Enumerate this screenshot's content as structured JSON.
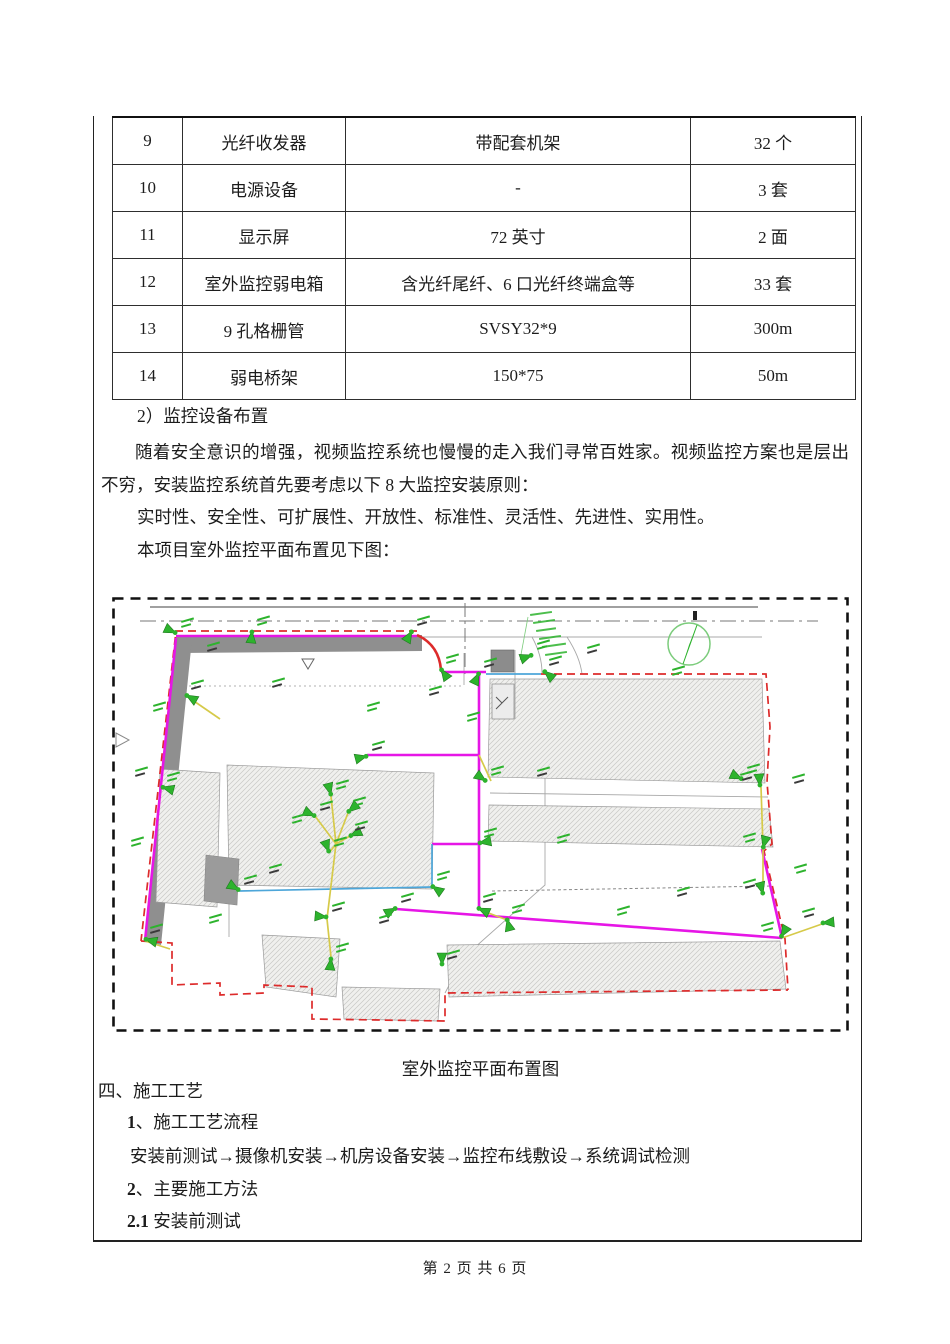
{
  "table": {
    "rows": [
      {
        "no": "9",
        "name": "光纤收发器",
        "spec": "带配套机架",
        "qty": "32 个"
      },
      {
        "no": "10",
        "name": "电源设备",
        "spec": "-",
        "qty": "3 套"
      },
      {
        "no": "11",
        "name": "显示屏",
        "spec": "72 英寸",
        "qty": "2 面"
      },
      {
        "no": "12",
        "name": "室外监控弱电箱",
        "spec": "含光纤尾纤、6 口光纤终端盒等",
        "qty": "33 套"
      },
      {
        "no": "13",
        "name": "9 孔格栅管",
        "spec": "SVSY32*9",
        "qty": "300m"
      },
      {
        "no": "14",
        "name": "弱电桥架",
        "spec": "150*75",
        "qty": "50m"
      }
    ]
  },
  "paragraphs": {
    "item2_heading": "2）监控设备布置",
    "p1": "随着安全意识的增强，视频监控系统也慢慢的走入我们寻常百姓家。视频监控方案也是层出不穷，安装监控系统首先要考虑以下 8 大监控安装原则：",
    "p2": "实时性、安全性、可扩展性、开放性、标准性、灵活性、先进性、实用性。",
    "p3": "本项目室外监控平面布置见下图："
  },
  "figure": {
    "caption": "室外监控平面布置图",
    "colors": {
      "magenta": "#e616e6",
      "red": "#dd2b2b",
      "green": "#2db32d",
      "yellow": "#d6ca49",
      "blue": "#4da6d9",
      "road": "#8f8f8f"
    },
    "cameras": [
      [
        64,
        36,
        205
      ],
      [
        74,
        98,
        30
      ],
      [
        50,
        190,
        15
      ],
      [
        33,
        342,
        15
      ],
      [
        140,
        34,
        95
      ],
      [
        300,
        34,
        120
      ],
      [
        329,
        72,
        55
      ],
      [
        367,
        76,
        115
      ],
      [
        420,
        58,
        160
      ],
      [
        432,
        74,
        40
      ],
      [
        374,
        184,
        215
      ],
      [
        255,
        159,
        165
      ],
      [
        219,
        198,
        255
      ],
      [
        203,
        219,
        205
      ],
      [
        236,
        215,
        320
      ],
      [
        238,
        239,
        335
      ],
      [
        217,
        255,
        250
      ],
      [
        215,
        320,
        185
      ],
      [
        219,
        361,
        95
      ],
      [
        284,
        311,
        150
      ],
      [
        320,
        289,
        35
      ],
      [
        127,
        293,
        210
      ],
      [
        367,
        246,
        350
      ],
      [
        366,
        311,
        25
      ],
      [
        395,
        322,
        75
      ],
      [
        648,
        189,
        265
      ],
      [
        651,
        251,
        285
      ],
      [
        651,
        297,
        255
      ],
      [
        669,
        340,
        300
      ],
      [
        710,
        326,
        355
      ],
      [
        630,
        182,
        205
      ],
      [
        330,
        368,
        270
      ]
    ],
    "extra_labels": [
      [
        90,
        60
      ],
      [
        36,
        120
      ],
      [
        18,
        185
      ],
      [
        14,
        255
      ],
      [
        155,
        96
      ],
      [
        250,
        120
      ],
      [
        312,
        104
      ],
      [
        350,
        130
      ],
      [
        420,
        185
      ],
      [
        175,
        232
      ],
      [
        152,
        282
      ],
      [
        92,
        332
      ],
      [
        262,
        332
      ],
      [
        440,
        252
      ],
      [
        470,
        62
      ],
      [
        555,
        84
      ],
      [
        700,
        192
      ],
      [
        702,
        282
      ],
      [
        560,
        305
      ],
      [
        500,
        324
      ]
    ]
  },
  "section4": {
    "heading": "四、施工工艺",
    "sub1_num": "1",
    "sub1_rest": "、施工工艺流程",
    "flow": "安装前测试→摄像机安装→机房设备安装→监控布线敷设→系统调试检测",
    "sub2_num": "2",
    "sub2_rest": "、主要施工方法",
    "sub21_num": "2.1",
    "sub21_rest": " 安装前测试"
  },
  "footer": {
    "page_text": "第 2 页 共 6 页"
  }
}
